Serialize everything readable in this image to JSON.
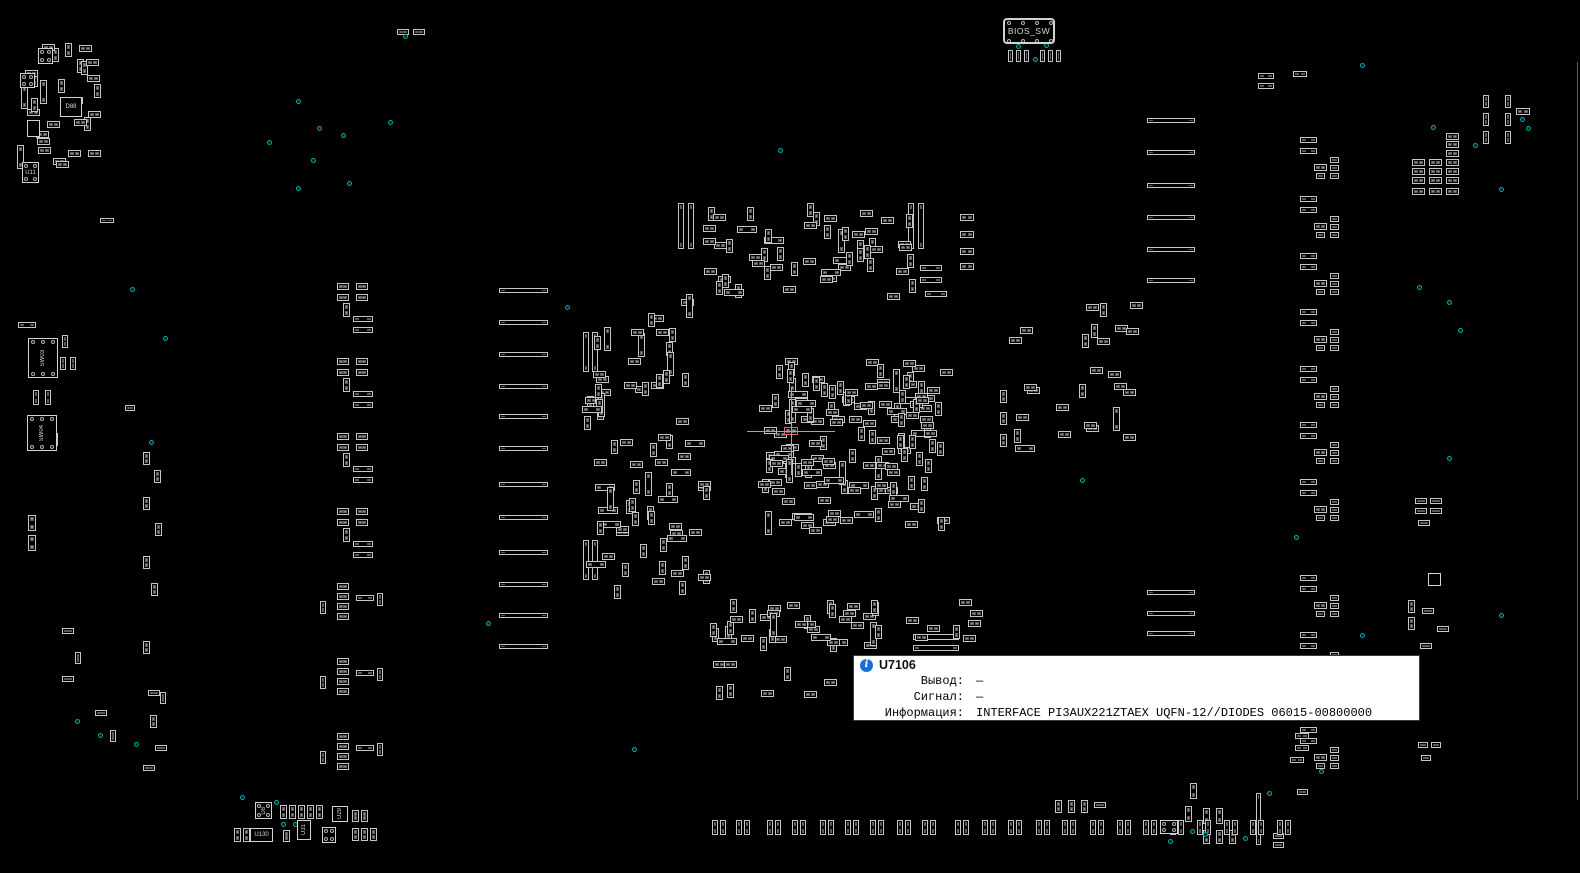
{
  "tooltip": {
    "ref": "U7106",
    "rows": [
      {
        "label": "Вывод:",
        "value": "—"
      },
      {
        "label": "Сигнал:",
        "value": "—"
      },
      {
        "label": "Информация:",
        "value": "INTERFACE PI3AUX221ZTAEX UQFN-12//DIODES 06015-00800000"
      }
    ]
  },
  "colors": {
    "background": "#000000",
    "component_outline": "#c6c6c6",
    "pad_fill": "#8f8f8f",
    "test_point": "#0da5a5",
    "crosshair": "#d98f8f",
    "tooltip_bg": "#ffffff",
    "info_icon": "#1a6fd4"
  },
  "board": {
    "chips": [
      {
        "x": 1003,
        "y": 18,
        "w": 52,
        "h": 26,
        "label": "BIOS_SW",
        "vert": false,
        "pins": "tb4",
        "big": true
      },
      {
        "x": 28,
        "y": 338,
        "w": 30,
        "h": 40,
        "label": "SW03",
        "vert": true,
        "pins": "tb3",
        "big": false
      },
      {
        "x": 27,
        "y": 415,
        "w": 30,
        "h": 36,
        "label": "SW04",
        "vert": true,
        "pins": "tb3",
        "big": false
      },
      {
        "x": 22,
        "y": 162,
        "w": 17,
        "h": 21,
        "label": "U11",
        "vert": false,
        "pins": "corner",
        "big": false
      },
      {
        "x": 60,
        "y": 97,
        "w": 22,
        "h": 20,
        "label": "D88",
        "vert": false,
        "pins": "none",
        "big": false
      },
      {
        "x": 38,
        "y": 48,
        "w": 15,
        "h": 16,
        "label": "",
        "vert": false,
        "pins": "corner",
        "big": false
      },
      {
        "x": 20,
        "y": 73,
        "w": 15,
        "h": 15,
        "label": "",
        "vert": false,
        "pins": "corner",
        "big": false
      },
      {
        "x": 27,
        "y": 120,
        "w": 13,
        "h": 17,
        "label": "",
        "vert": true,
        "pins": "none",
        "big": false
      },
      {
        "x": 255,
        "y": 802,
        "w": 17,
        "h": 17,
        "label": "D8",
        "vert": true,
        "pins": "corner",
        "big": false
      },
      {
        "x": 250,
        "y": 828,
        "w": 23,
        "h": 14,
        "label": "U130",
        "vert": false,
        "pins": "none",
        "big": false
      },
      {
        "x": 297,
        "y": 820,
        "w": 14,
        "h": 20,
        "label": "U31",
        "vert": true,
        "pins": "none",
        "big": false
      },
      {
        "x": 322,
        "y": 827,
        "w": 14,
        "h": 16,
        "label": "",
        "vert": false,
        "pins": "corner",
        "big": false
      },
      {
        "x": 332,
        "y": 806,
        "w": 16,
        "h": 16,
        "label": "U29",
        "vert": true,
        "pins": "none",
        "big": false
      },
      {
        "x": 1160,
        "y": 820,
        "w": 18,
        "h": 14,
        "label": "",
        "vert": false,
        "pins": "corner",
        "big": false
      },
      {
        "x": 1428,
        "y": 573,
        "w": 13,
        "h": 13,
        "label": "",
        "vert": false,
        "pins": "none",
        "big": false
      }
    ],
    "bar_columns": [
      {
        "x": 499,
        "w": 49,
        "h": 5,
        "ys": [
          288,
          320,
          352,
          384,
          414,
          446,
          482,
          515,
          550,
          582,
          613,
          644
        ]
      },
      {
        "x": 1147,
        "w": 48,
        "h": 5,
        "ys": [
          118,
          150,
          183,
          215,
          247,
          278
        ]
      },
      {
        "x": 1147,
        "w": 48,
        "h": 5,
        "ys": [
          590,
          611,
          631
        ]
      }
    ],
    "bottom_pairs": {
      "y": 820,
      "pad_w": 6,
      "pad_h": 15,
      "gap": 8,
      "xs": [
        712,
        736,
        767,
        792,
        820,
        845,
        870,
        897,
        922,
        955,
        982,
        1008,
        1036,
        1062,
        1090,
        1117,
        1143,
        1170,
        1197,
        1224,
        1250,
        1277
      ]
    },
    "left_units": {
      "ys": [
        283,
        358,
        433,
        508
      ],
      "parts": [
        [
          337,
          0,
          12,
          7
        ],
        [
          356,
          0,
          12,
          7
        ],
        [
          337,
          11,
          12,
          7
        ],
        [
          356,
          11,
          12,
          7
        ],
        [
          343,
          20,
          7,
          14
        ],
        [
          353,
          33,
          20,
          6
        ],
        [
          353,
          44,
          20,
          6
        ]
      ]
    },
    "left_units2": {
      "ys": [
        583,
        658,
        733
      ],
      "parts": [
        [
          337,
          0,
          12,
          7
        ],
        [
          337,
          10,
          12,
          7
        ],
        [
          337,
          20,
          12,
          7
        ],
        [
          337,
          30,
          12,
          7
        ],
        [
          356,
          12,
          18,
          6
        ],
        [
          377,
          10,
          6,
          13
        ],
        [
          320,
          18,
          6,
          13
        ]
      ]
    },
    "right_units": {
      "ys": [
        137,
        196,
        253,
        309,
        366,
        422,
        479,
        575,
        632,
        727
      ],
      "parts": [
        [
          1300,
          0,
          17,
          6
        ],
        [
          1300,
          11,
          17,
          6
        ],
        [
          1314,
          27,
          13,
          7
        ],
        [
          1330,
          20,
          9,
          6
        ],
        [
          1330,
          28,
          9,
          6
        ],
        [
          1330,
          36,
          9,
          6
        ],
        [
          1316,
          36,
          9,
          6
        ]
      ]
    },
    "clusters": [
      {
        "name": "cpu-field",
        "x": 757,
        "y": 357,
        "w": 196,
        "h": 178,
        "count": 150,
        "seed": 7
      },
      {
        "name": "north-field",
        "x": 698,
        "y": 200,
        "w": 218,
        "h": 100,
        "count": 55,
        "seed": 11
      },
      {
        "name": "west-field",
        "x": 575,
        "y": 290,
        "w": 138,
        "h": 310,
        "count": 80,
        "seed": 13
      },
      {
        "name": "south-field",
        "x": 707,
        "y": 597,
        "w": 288,
        "h": 55,
        "count": 45,
        "seed": 17
      },
      {
        "name": "topleft-field",
        "x": 12,
        "y": 42,
        "w": 110,
        "h": 130,
        "count": 30,
        "seed": 19
      },
      {
        "name": "east-field",
        "x": 1008,
        "y": 300,
        "w": 140,
        "h": 170,
        "count": 26,
        "seed": 23
      },
      {
        "name": "tooltip-left-field",
        "x": 705,
        "y": 660,
        "w": 140,
        "h": 42,
        "count": 8,
        "seed": 29
      }
    ],
    "components": [
      [
        18,
        322,
        18,
        6
      ],
      [
        62,
        335,
        6,
        13
      ],
      [
        60,
        357,
        6,
        13
      ],
      [
        70,
        357,
        6,
        13
      ],
      [
        33,
        390,
        6,
        15
      ],
      [
        45,
        390,
        6,
        15
      ],
      [
        52,
        433,
        6,
        13
      ],
      [
        28,
        515,
        8,
        16
      ],
      [
        28,
        535,
        8,
        16
      ],
      [
        100,
        218,
        14,
        5
      ],
      [
        125,
        405,
        10,
        6
      ],
      [
        143,
        452,
        7,
        13
      ],
      [
        154,
        470,
        7,
        13
      ],
      [
        143,
        497,
        7,
        13
      ],
      [
        155,
        523,
        7,
        13
      ],
      [
        143,
        556,
        7,
        13
      ],
      [
        151,
        583,
        7,
        13
      ],
      [
        143,
        641,
        7,
        13
      ],
      [
        148,
        690,
        12,
        6
      ],
      [
        160,
        692,
        6,
        12
      ],
      [
        150,
        715,
        7,
        13
      ],
      [
        155,
        745,
        12,
        6
      ],
      [
        143,
        765,
        12,
        6
      ],
      [
        62,
        628,
        12,
        6
      ],
      [
        75,
        652,
        6,
        12
      ],
      [
        62,
        676,
        12,
        6
      ],
      [
        95,
        710,
        12,
        6
      ],
      [
        110,
        730,
        6,
        12
      ],
      [
        397,
        29,
        12,
        6
      ],
      [
        413,
        29,
        12,
        6
      ],
      [
        678,
        203,
        6,
        46
      ],
      [
        688,
        203,
        6,
        46
      ],
      [
        908,
        203,
        6,
        46
      ],
      [
        918,
        203,
        6,
        46
      ],
      [
        920,
        265,
        22,
        6
      ],
      [
        920,
        277,
        22,
        6
      ],
      [
        925,
        291,
        22,
        6
      ],
      [
        960,
        214,
        14,
        7
      ],
      [
        960,
        231,
        14,
        7
      ],
      [
        960,
        248,
        14,
        7
      ],
      [
        960,
        263,
        14,
        7
      ],
      [
        1000,
        390,
        7,
        13
      ],
      [
        1000,
        412,
        7,
        13
      ],
      [
        1000,
        434,
        7,
        13
      ],
      [
        583,
        332,
        6,
        40
      ],
      [
        592,
        332,
        6,
        40
      ],
      [
        583,
        540,
        6,
        40
      ],
      [
        592,
        540,
        6,
        40
      ],
      [
        913,
        634,
        46,
        6
      ],
      [
        913,
        645,
        46,
        6
      ],
      [
        1008,
        50,
        5,
        12
      ],
      [
        1016,
        50,
        5,
        12
      ],
      [
        1024,
        50,
        5,
        12
      ],
      [
        1040,
        50,
        5,
        12
      ],
      [
        1048,
        50,
        5,
        12
      ],
      [
        1056,
        50,
        5,
        12
      ],
      [
        1258,
        73,
        16,
        6
      ],
      [
        1258,
        83,
        16,
        6
      ],
      [
        1293,
        71,
        14,
        6
      ],
      [
        1412,
        159,
        13,
        7
      ],
      [
        1429,
        159,
        13,
        7
      ],
      [
        1446,
        159,
        13,
        7
      ],
      [
        1412,
        168,
        13,
        7
      ],
      [
        1429,
        168,
        13,
        7
      ],
      [
        1446,
        168,
        13,
        7
      ],
      [
        1412,
        177,
        13,
        7
      ],
      [
        1429,
        177,
        13,
        7
      ],
      [
        1446,
        177,
        13,
        7
      ],
      [
        1412,
        188,
        13,
        7
      ],
      [
        1429,
        188,
        13,
        7
      ],
      [
        1446,
        188,
        13,
        7
      ],
      [
        1446,
        133,
        13,
        7
      ],
      [
        1446,
        141,
        13,
        7
      ],
      [
        1446,
        150,
        13,
        7
      ],
      [
        1483,
        95,
        6,
        13
      ],
      [
        1483,
        113,
        6,
        13
      ],
      [
        1505,
        95,
        6,
        13
      ],
      [
        1505,
        113,
        6,
        13
      ],
      [
        1483,
        131,
        6,
        13
      ],
      [
        1505,
        131,
        6,
        13
      ],
      [
        1516,
        108,
        14,
        7
      ],
      [
        1415,
        498,
        12,
        6
      ],
      [
        1430,
        498,
        12,
        6
      ],
      [
        1415,
        508,
        12,
        6
      ],
      [
        1430,
        508,
        12,
        6
      ],
      [
        1418,
        520,
        12,
        6
      ],
      [
        1408,
        600,
        7,
        13
      ],
      [
        1408,
        617,
        7,
        13
      ],
      [
        1422,
        608,
        12,
        6
      ],
      [
        1437,
        626,
        12,
        6
      ],
      [
        1420,
        643,
        12,
        6
      ],
      [
        1418,
        742,
        10,
        6
      ],
      [
        1431,
        742,
        10,
        6
      ],
      [
        1421,
        755,
        10,
        6
      ],
      [
        1295,
        733,
        14,
        6
      ],
      [
        1295,
        745,
        14,
        6
      ],
      [
        1290,
        757,
        14,
        6
      ],
      [
        1185,
        806,
        7,
        16
      ],
      [
        1203,
        808,
        7,
        16
      ],
      [
        1216,
        808,
        7,
        16
      ],
      [
        1203,
        830,
        7,
        14
      ],
      [
        1216,
        830,
        7,
        14
      ],
      [
        1229,
        830,
        7,
        14
      ],
      [
        1190,
        783,
        7,
        16
      ],
      [
        1256,
        793,
        5,
        52
      ],
      [
        1273,
        833,
        11,
        6
      ],
      [
        1273,
        842,
        11,
        6
      ],
      [
        1297,
        789,
        11,
        6
      ],
      [
        1055,
        800,
        7,
        13
      ],
      [
        1068,
        800,
        7,
        13
      ],
      [
        1081,
        800,
        7,
        13
      ],
      [
        1094,
        802,
        12,
        6
      ],
      [
        280,
        805,
        7,
        14
      ],
      [
        289,
        805,
        7,
        14
      ],
      [
        298,
        805,
        7,
        14
      ],
      [
        307,
        805,
        7,
        14
      ],
      [
        316,
        805,
        7,
        14
      ],
      [
        352,
        810,
        7,
        12
      ],
      [
        361,
        810,
        7,
        12
      ],
      [
        234,
        828,
        7,
        14
      ],
      [
        243,
        828,
        7,
        14
      ],
      [
        283,
        830,
        7,
        12
      ],
      [
        352,
        828,
        7,
        13
      ],
      [
        361,
        828,
        7,
        13
      ],
      [
        370,
        828,
        7,
        13
      ]
    ],
    "dots": [
      [
        403,
        34
      ],
      [
        296,
        99
      ],
      [
        317,
        126
      ],
      [
        341,
        133
      ],
      [
        388,
        120
      ],
      [
        267,
        140
      ],
      [
        311,
        158
      ],
      [
        296,
        186
      ],
      [
        347,
        181
      ],
      [
        1016,
        44
      ],
      [
        1044,
        43
      ],
      [
        1033,
        57
      ],
      [
        130,
        287
      ],
      [
        163,
        336
      ],
      [
        149,
        440
      ],
      [
        43,
        357
      ],
      [
        41,
        432
      ],
      [
        75,
        719
      ],
      [
        98,
        733
      ],
      [
        134,
        742
      ],
      [
        240,
        795
      ],
      [
        274,
        800
      ],
      [
        281,
        822
      ],
      [
        293,
        822
      ],
      [
        632,
        747
      ],
      [
        778,
        148
      ],
      [
        565,
        305
      ],
      [
        486,
        621
      ],
      [
        1431,
        125
      ],
      [
        1520,
        117
      ],
      [
        1526,
        126
      ],
      [
        1473,
        143
      ],
      [
        1499,
        187
      ],
      [
        1417,
        285
      ],
      [
        1447,
        300
      ],
      [
        1458,
        328
      ],
      [
        1294,
        535
      ],
      [
        1360,
        63
      ],
      [
        1080,
        478
      ],
      [
        1168,
        839
      ],
      [
        1190,
        829
      ],
      [
        1203,
        832
      ],
      [
        1243,
        836
      ],
      [
        1267,
        791
      ],
      [
        1319,
        769
      ],
      [
        1447,
        456
      ],
      [
        1499,
        613
      ],
      [
        1360,
        633
      ]
    ],
    "crosshair": {
      "x": 791,
      "y": 431,
      "half": 44,
      "comp": [
        784,
        427,
        14,
        8
      ]
    },
    "edge_line": {
      "x": 1577,
      "y1": 62,
      "y2": 800
    }
  }
}
